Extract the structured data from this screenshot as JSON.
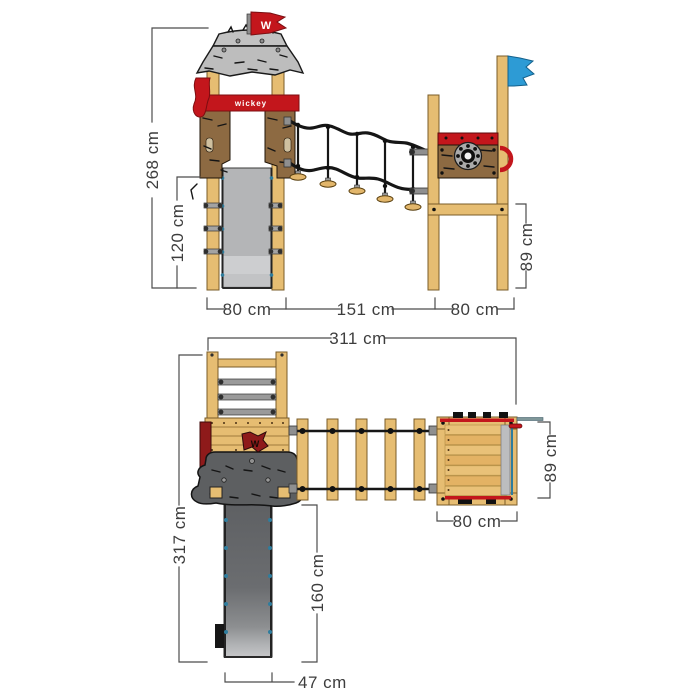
{
  "brand": {
    "logo_text": "wickey",
    "flag_monogram": "W"
  },
  "dims": {
    "elevation": {
      "total_height": "268 cm",
      "platform_height": "120 cm",
      "deck_height": "89 cm",
      "left_width": "80 cm",
      "bridge_span": "151 cm",
      "right_width": "80 cm"
    },
    "plan": {
      "total_width": "311 cm",
      "total_depth": "317 cm",
      "slide_run": "160 cm",
      "deck_depth": "89 cm",
      "deck_width": "80 cm",
      "slide_width": "47 cm"
    }
  },
  "colors": {
    "wood": "#e6bd72",
    "panel_brown": "#8d6a42",
    "accent_red": "#c3161c",
    "dark_red": "#8e1a1a",
    "roof_gray": "#bdbdbd",
    "rock_gray": "#5d5f61",
    "slide_gray": "#b4b5b7",
    "flag_blue": "#2d9bd5",
    "rope_black": "#161616",
    "dimension_gray": "#4c4c4c",
    "bolt_teal": "#2e7d9e"
  }
}
